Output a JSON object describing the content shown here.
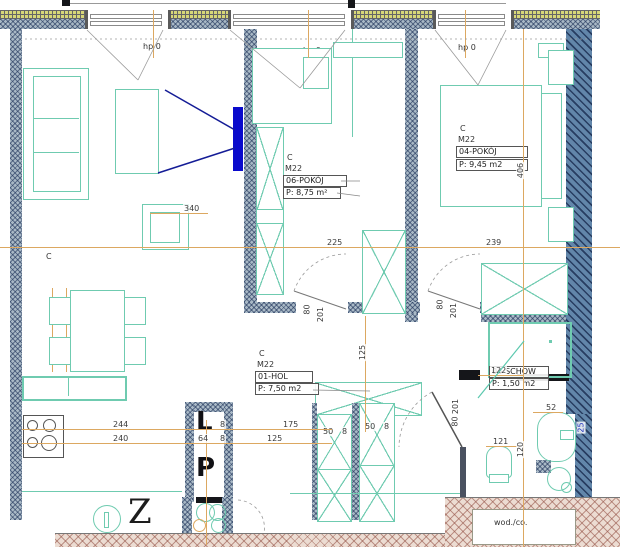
{
  "plan_title": "apartment-floor-plan",
  "windows": {
    "sill_label": "hp 0"
  },
  "rooms": {
    "living": {
      "class_mark": "C"
    },
    "pokoj06": {
      "class_mark": "C",
      "unit": "M22",
      "name": "06-POKÓJ",
      "area": "P: 8,75 m²"
    },
    "pokoj04": {
      "class_mark": "C",
      "unit": "M22",
      "name": "04-POKÓJ",
      "area": "P: 9,45 m2"
    },
    "hol": {
      "class_mark": "C",
      "unit": "M22",
      "name": "01-HOL",
      "area": "P: 7,50 m2"
    },
    "schowek": {
      "name": "06-SCHOW",
      "area": "P: 1,50 m2"
    },
    "shaft": {
      "marker_top": "L",
      "marker_bottom": "P"
    },
    "entry": {
      "marker": "Z"
    },
    "riser": {
      "label": "wod./co."
    }
  },
  "dimensions": {
    "d340": "340",
    "d225": "225",
    "d239": "239",
    "d406": "406",
    "d244": "244",
    "d240": "240",
    "d64": "64",
    "d175": "175",
    "d125": "125",
    "d8": "8",
    "d50": "50",
    "d122": "122",
    "d120": "120",
    "d121": "121",
    "d52": "52",
    "d25": "25",
    "door_w": "80",
    "door_h": "201"
  },
  "colors": {
    "furniture": "#6fcbb0",
    "tv": "#0a0acc",
    "dimension_line": "#dca861",
    "sight_line": "#141c96",
    "wall_gray": "#a9b9c6",
    "wall_dark": "#6286aa",
    "wall_yellow": "#d7d778",
    "wall_pink": "#ecdcd2"
  }
}
